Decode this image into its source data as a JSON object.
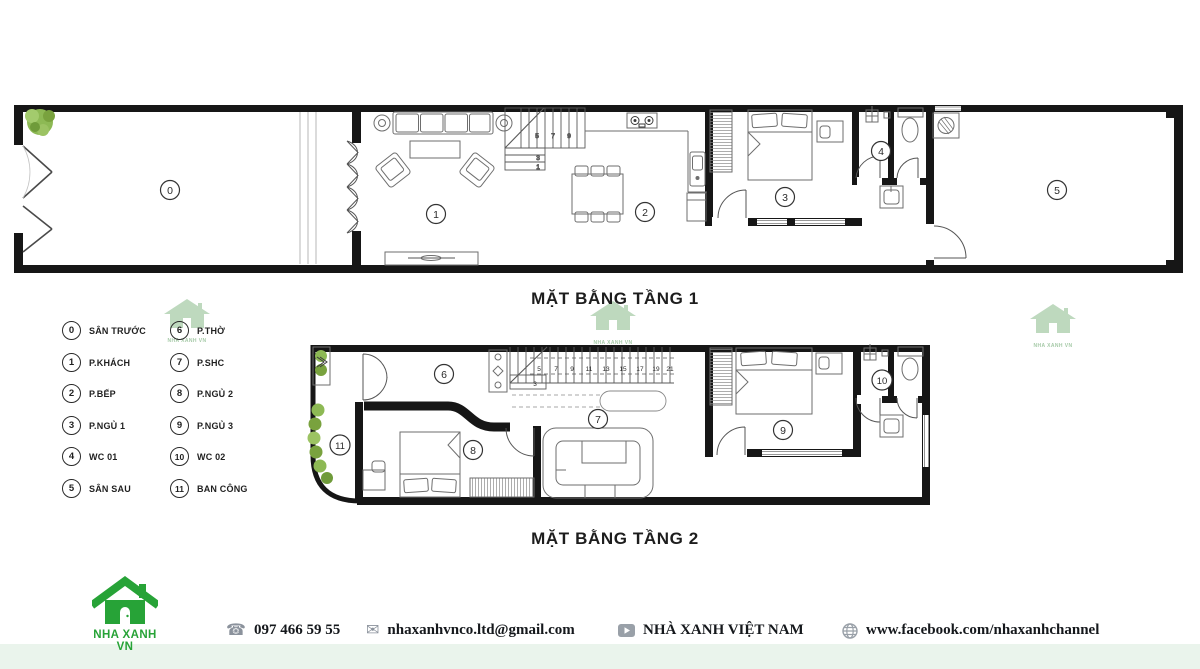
{
  "brand": {
    "name": "NHA XANH VN"
  },
  "colors": {
    "brand_green": "#27a337",
    "watermark_green": "#b7d5b8",
    "footer_bg": "#eaf4ec",
    "wall_black": "#161616"
  },
  "titles": {
    "floor1": "MẶT BẰNG TẦNG 1",
    "floor2": "MẶT BẰNG TẦNG 2"
  },
  "legend": {
    "left": [
      {
        "num": "0",
        "label": "SÂN TRƯỚC"
      },
      {
        "num": "1",
        "label": "P.KHÁCH"
      },
      {
        "num": "2",
        "label": "P.BẾP"
      },
      {
        "num": "3",
        "label": "P.NGỦ 1"
      },
      {
        "num": "4",
        "label": "WC 01"
      },
      {
        "num": "5",
        "label": "SÂN SAU"
      }
    ],
    "right": [
      {
        "num": "6",
        "label": "P.THỜ"
      },
      {
        "num": "7",
        "label": "P.SHC"
      },
      {
        "num": "8",
        "label": "P.NGỦ 2"
      },
      {
        "num": "9",
        "label": "P.NGỦ 3"
      },
      {
        "num": "10",
        "label": "WC 02"
      },
      {
        "num": "11",
        "label": "BAN CÔNG"
      }
    ]
  },
  "plan1": {
    "rooms": [
      "0",
      "1",
      "2",
      "3",
      "4",
      "5"
    ],
    "stairs": [
      "1",
      "3",
      "5",
      "7",
      "9"
    ]
  },
  "plan2": {
    "rooms": [
      "6",
      "7",
      "8",
      "9",
      "10",
      "11"
    ],
    "stairs": [
      "3",
      "5",
      "7",
      "9",
      "11",
      "13",
      "15",
      "17",
      "19",
      "21"
    ]
  },
  "footer": {
    "phone": "097 466 59 55",
    "email": "nhaxanhvnco.ltd@gmail.com",
    "channel": "NHÀ XANH VIỆT NAM",
    "website": "www.facebook.com/nhaxanhchannel"
  }
}
